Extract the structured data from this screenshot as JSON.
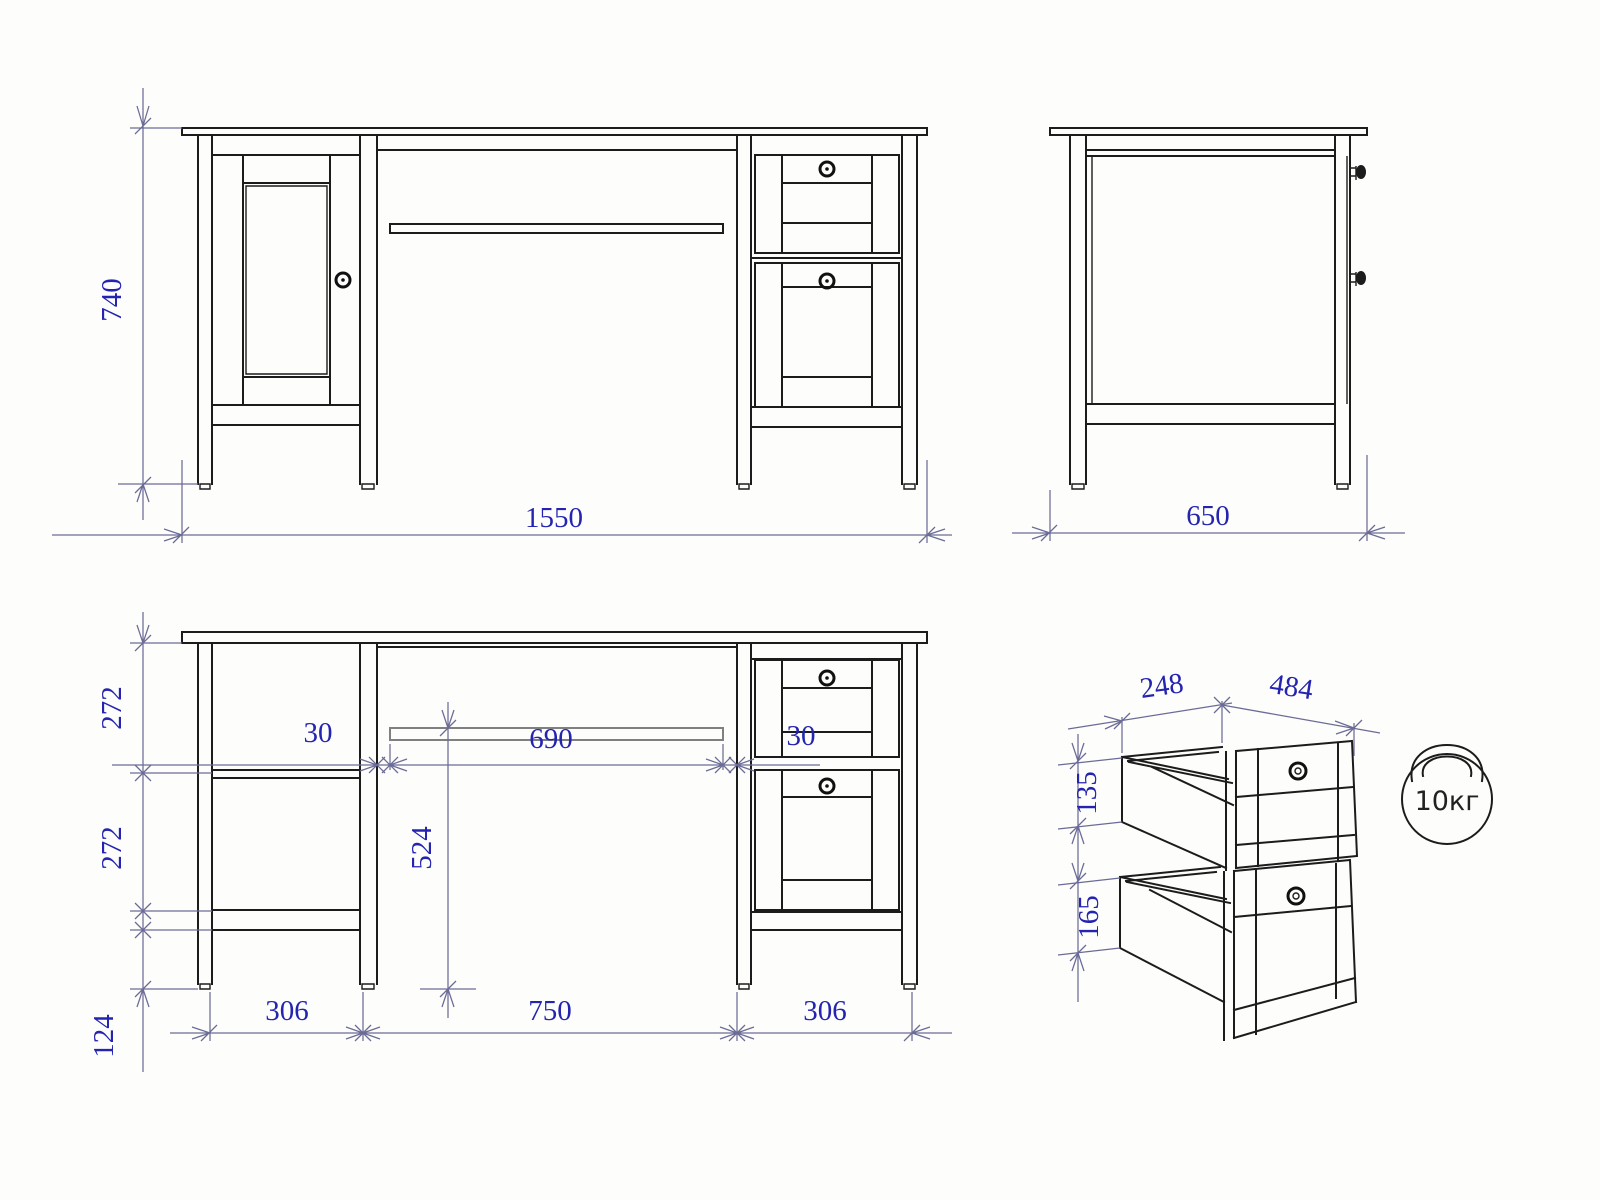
{
  "drawing": {
    "kind": "desk furniture dimension drawing",
    "colors": {
      "line": "#1c1c1c",
      "dimension": "#6b6b97",
      "label": "#2424b0",
      "background": "#fdfdfb"
    },
    "front_view": {
      "height": "740",
      "width": "1550"
    },
    "side_view": {
      "depth": "650"
    },
    "section_view": {
      "upper_compartment": "272",
      "lower_compartment": "272",
      "leg_height": "124",
      "tray_gap_left": "30",
      "tray_width": "690",
      "tray_gap_right": "30",
      "tray_to_floor": "524",
      "left_pedestal": "306",
      "knee_space": "750",
      "right_pedestal": "306"
    },
    "drawers_view": {
      "drawer_depth": "248",
      "drawer_width": "484",
      "top_drawer_height": "135",
      "bottom_drawer_height": "165",
      "max_load": "10кг"
    }
  }
}
